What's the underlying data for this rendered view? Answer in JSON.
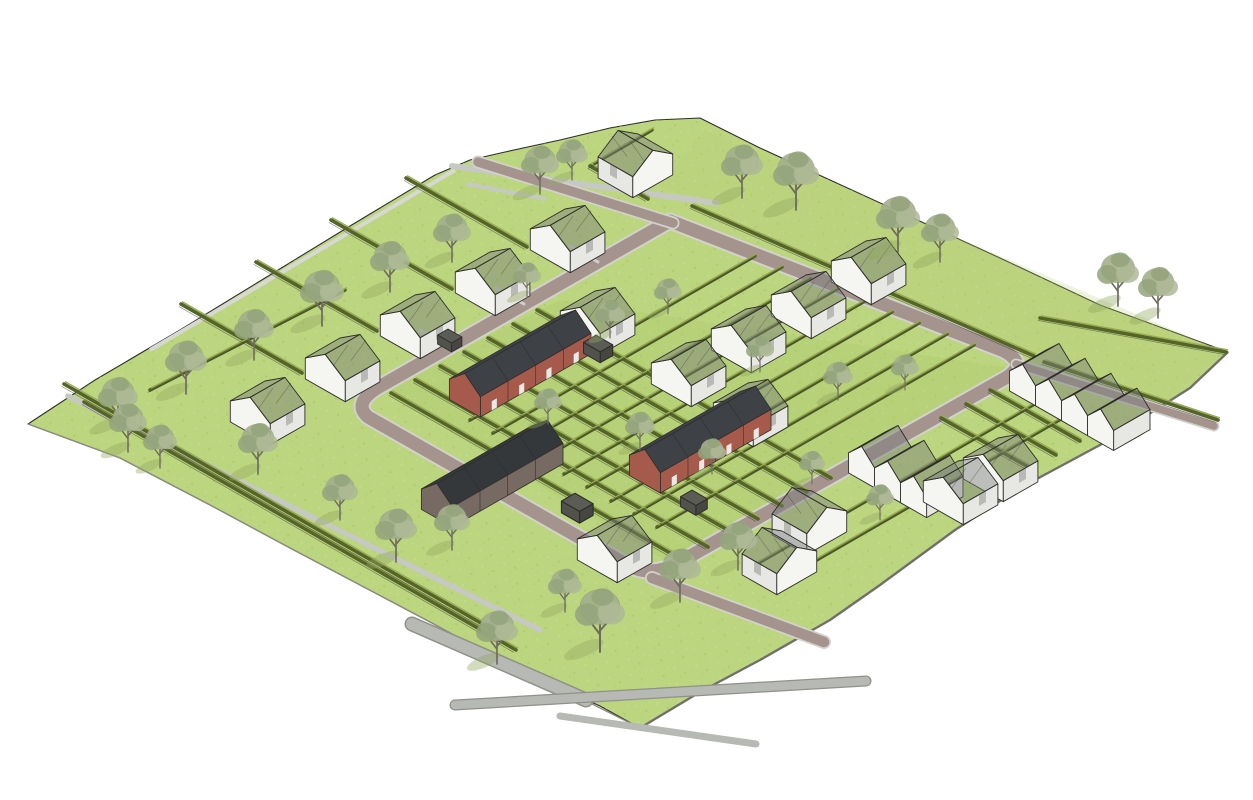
{
  "scene": {
    "description": "Axonometric architectural site-plan rendering of a small residential neighborhood: a green field crossed by a brick paving street loop with rounded corners, gray access roads and paths, hedged garden parcels in a diagonal grid, tree-lined verges, translucent white concept houses with gabled roofs, two red-brick terraced rows with dark roofs, and one dark farmhouse terrace row.",
    "background": "#ffffff",
    "buildings": {
      "white_concept_houses": 17,
      "white_terrace_units": 7,
      "brick_terrace_rows": 2,
      "dark_terrace_rows": 1,
      "sheds": 4
    },
    "landscape": {
      "trees": 36,
      "garden_hedges": true,
      "tree_lined_verges": true
    },
    "roads": {
      "primary_loop": "brick paving with light curb edges",
      "secondary": "gray asphalt",
      "paths": "narrow gray gravel"
    }
  },
  "colors": {
    "background": "#ffffff",
    "grass": "#bcd57f",
    "grass_light": "#d2e2a0",
    "grass_dot": "#a9c360",
    "road_brick": "#a5948e",
    "road_edge": "#d2d2cc",
    "road_gray": "#b7b9b4",
    "path_gray": "#c6c8c3",
    "hedge_dark": "#55652a",
    "hedge_light": "#97ab51",
    "fence_dark": "#34352e",
    "tree_foliage": "#a4b18d",
    "tree_foliage2": "#93a37b",
    "tree_trunk": "#6f6b60",
    "tree_shadow": "#90a75e",
    "house_white": "#f5f5f2",
    "house_shade": "#e7e7e3",
    "roof_glass": "#787d7b",
    "brick_red": "#a65a4b",
    "roof_dark": "#3e4246",
    "dark_wall": "#776a62",
    "dark_roof": "#35383b",
    "outline": "#2e2e2a",
    "slab_edge": "#70706a"
  }
}
